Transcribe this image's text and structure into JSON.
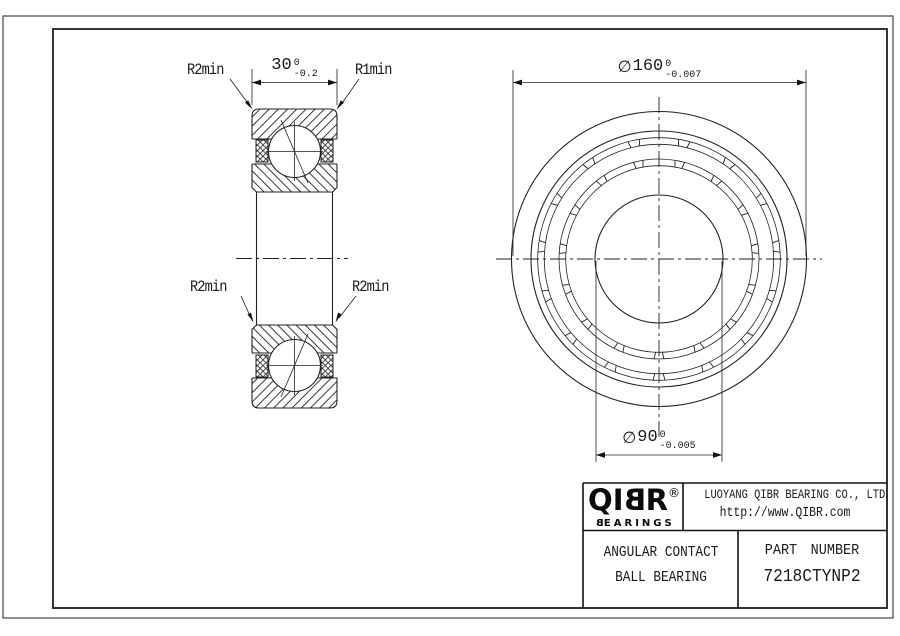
{
  "sheet": {
    "bg": "#ffffff",
    "line_color": "#222222"
  },
  "dims": {
    "width": {
      "value": "30",
      "tol_upper": "0",
      "tol_lower": "-0.2"
    },
    "od": {
      "phi": "∅",
      "value": "160",
      "tol_upper": "0",
      "tol_lower": "-0.007"
    },
    "bore": {
      "phi": "∅",
      "value": "90",
      "tol_upper": "0",
      "tol_lower": "-0.005"
    }
  },
  "labels": {
    "r2_top_left": "R2min",
    "r1_top_right": "R1min",
    "r2_mid_left": "R2min",
    "r2_mid_right": "R2min"
  },
  "title_block": {
    "logo": {
      "part1": "QI",
      "part2": "B",
      "part3": "R",
      "registered": "®",
      "sub1": "B",
      "sub2": "EARINGS"
    },
    "company": "LUOYANG QIBR BEARING CO., LTD",
    "website": "http://www.QIBR.com",
    "product_line1": "ANGULAR CONTACT",
    "product_line2": "BALL BEARING",
    "part_number_label": "PART NUMBER",
    "part_number_value": "7218CTYNP2"
  }
}
